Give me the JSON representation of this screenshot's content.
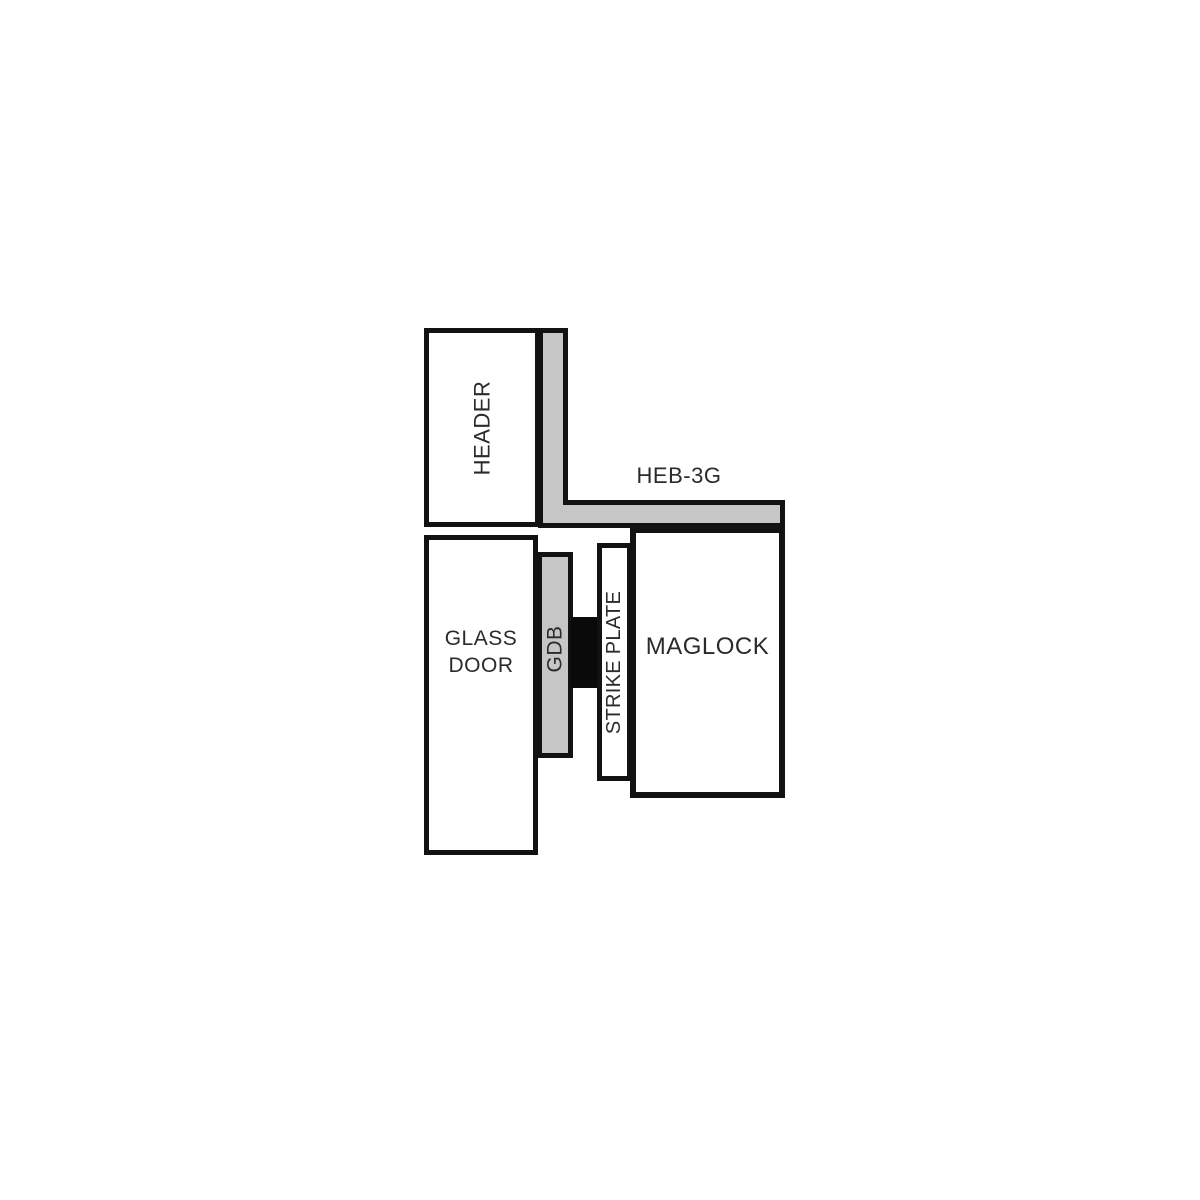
{
  "colors": {
    "page-bg": "#ffffff",
    "line": "#121212",
    "bracket-gray": "#c6c6c6",
    "block-black": "#0a0a0a",
    "box-white": "#ffffff",
    "label-text": "#2b2b2b"
  },
  "diagram": {
    "labels": {
      "header": "HEADER",
      "bracket": "HEB-3G",
      "glass_door": "GLASS DOOR",
      "gdb": "GDB",
      "strike_plate": "STRIKE PLATE",
      "maglock": "MAGLOCK"
    }
  }
}
